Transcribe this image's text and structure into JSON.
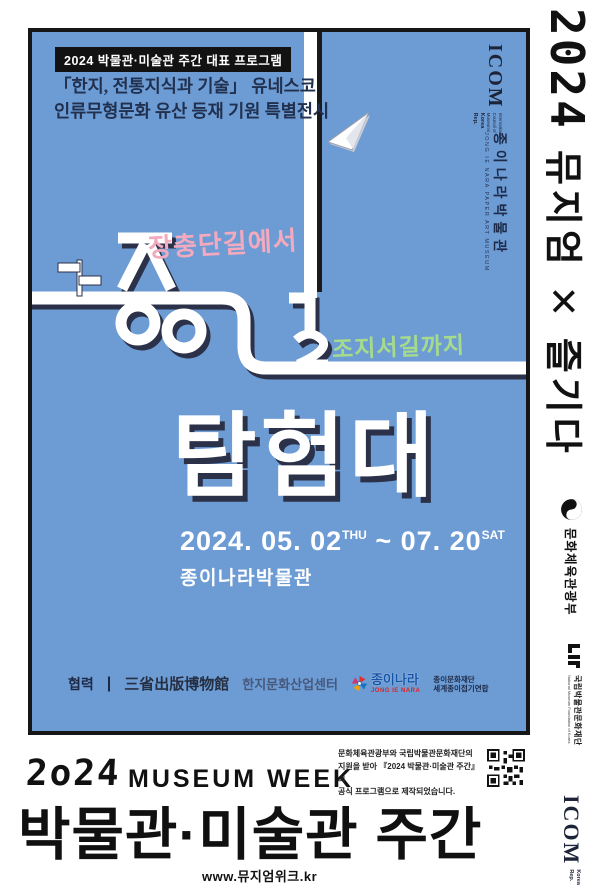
{
  "poster": {
    "bg_color": "#6D9CD4",
    "badge": "2024 박물관·미술관 주간 대표 프로그램",
    "subtitle_line1": "「한지, 전통지식과 기술」 유네스코",
    "subtitle_line2": "인류무형문화 유산 등재 기원 특별전시",
    "icom_corner": {
      "name": "ICOM",
      "sub": "International Council of Museums",
      "region": "Korea Rep."
    },
    "museum_vertical": {
      "kr": "종이나라박물관",
      "en": "JONG IE NARA PAPER ART MUSEUM"
    },
    "title": {
      "word_road": "종이길",
      "word_team": "탐험대",
      "from_label": "장충단길에서",
      "to_label": "조지서길까지",
      "pink": "#F3A9BE",
      "green": "#A6DB8B"
    },
    "schedule": {
      "start": "2024. 05. 02",
      "start_day": "THU",
      "tilde": " ~ ",
      "end": "07. 20",
      "end_day": "SAT"
    },
    "venue": "종이나라박물관",
    "cooperation": {
      "label": "협력",
      "divider": "|",
      "partners": [
        {
          "name": "三省出版博物館"
        },
        {
          "name": "한지문화산업센터"
        },
        {
          "name": "종이나라",
          "sub": "JONG IE NARA"
        },
        {
          "name": "종이문화재단",
          "sub": "세계종이접기연합"
        }
      ]
    }
  },
  "rail": {
    "year_mark": "2024",
    "slogan": "뮤지엄 ✕ 즐기다",
    "mcst": "문화체육관광부",
    "nmf": {
      "kr": "국립박물관문화재단",
      "en": "National Museum Foundation of Korea"
    },
    "icom": {
      "name": "ICOM",
      "region": "Korea Rep."
    }
  },
  "footer": {
    "year": "2o24",
    "logotype_en": "MUSEUM WEEK",
    "logotype_kr": "박물관·미술관 주간",
    "url": "www.뮤지엄위크.kr",
    "credit_line1": "문화체육관광부와 국립박물관문화재단의",
    "credit_line2": "지원을 받아 『2024 박물관·미술관 주간』의",
    "credit_line3": "공식 프로그램으로 제작되었습니다."
  }
}
